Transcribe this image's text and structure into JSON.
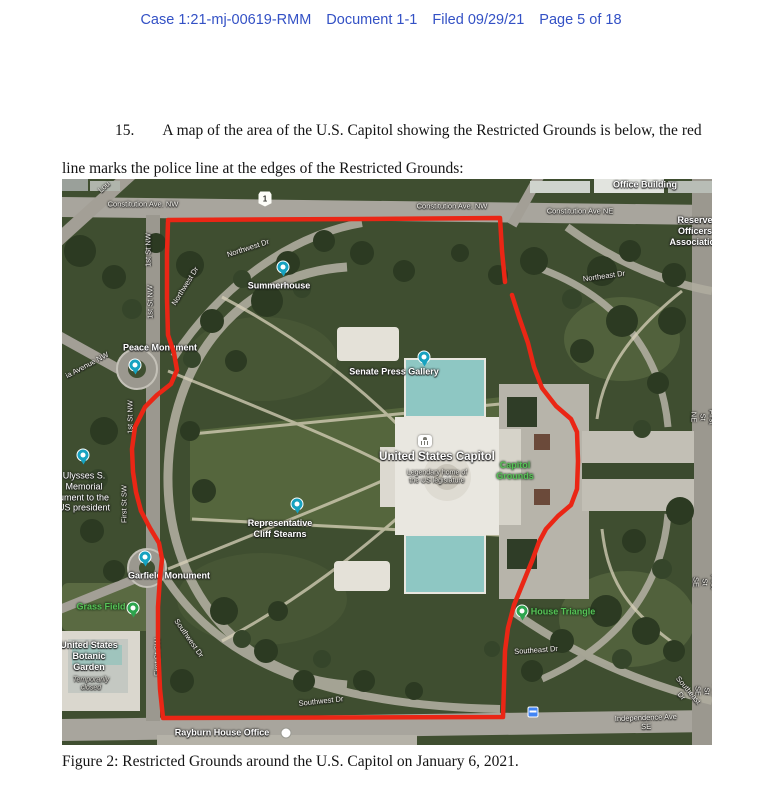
{
  "header": {
    "case": "Case 1:21-mj-00619-RMM",
    "document": "Document 1-1",
    "filed": "Filed 09/29/21",
    "page": "Page 5 of 18"
  },
  "paragraph": {
    "number": "15.",
    "text": "A map of the area of the U.S. Capitol showing the Restricted Grounds is below, the red line marks the police line at the edges of the Restricted Grounds:"
  },
  "caption": "Figure 2: Restricted Grounds around the U.S. Capitol on January 6, 2021.",
  "colors": {
    "header_blue": "#3351c5",
    "police_line_red": "#ea2615",
    "map_label_green": "#57c257",
    "pin_teal": "#17a2c0",
    "pin_green": "#2da54e"
  },
  "map": {
    "shield": "1",
    "road_labels": [
      {
        "text": "Constitution Ave. NW"
      },
      {
        "text": "Constitution Ave. NW"
      },
      {
        "text": "Constitution Ave NE"
      },
      {
        "text": "Northwest Dr"
      },
      {
        "text": "Northwest Dr"
      },
      {
        "text": "Northeast Dr"
      },
      {
        "text": "1st St NW"
      },
      {
        "text": "1st St NW"
      },
      {
        "text": "1st St NW"
      },
      {
        "text": "First St SW"
      },
      {
        "text": "First St SW"
      },
      {
        "text": "First St NE"
      },
      {
        "text": "First St SE"
      },
      {
        "text": "First St SE"
      },
      {
        "text": "Southwest Dr"
      },
      {
        "text": "Southwest Dr"
      },
      {
        "text": "Southeast Dr"
      },
      {
        "text": "Southeast Dr"
      },
      {
        "text": "Independence Ave SE"
      },
      {
        "text": "Lou"
      },
      {
        "text": "ia Avenue NW"
      }
    ],
    "poi_labels": [
      {
        "text": "Office Building"
      },
      {
        "text": "Reserve Officers\nAssociation"
      },
      {
        "text": "Summerhouse"
      },
      {
        "text": "Peace Monument"
      },
      {
        "text": "Senate Press Gallery"
      },
      {
        "text": "United States Capitol"
      },
      {
        "text": "Legendary home of\nthe US legislature"
      },
      {
        "text": "Capitol\nGrounds"
      },
      {
        "text": "Representative\nCliff Stearns"
      },
      {
        "text": "Garfield Monument"
      },
      {
        "text": "Grass Field"
      },
      {
        "text": "United States\nBotanic\nGarden"
      },
      {
        "text": "Temporarily\nclosed"
      },
      {
        "text": "House Triangle"
      },
      {
        "text": "Ulysses S.\nMemorial\nument to the\nUS president"
      },
      {
        "text": "Rayburn House Office"
      }
    ]
  }
}
